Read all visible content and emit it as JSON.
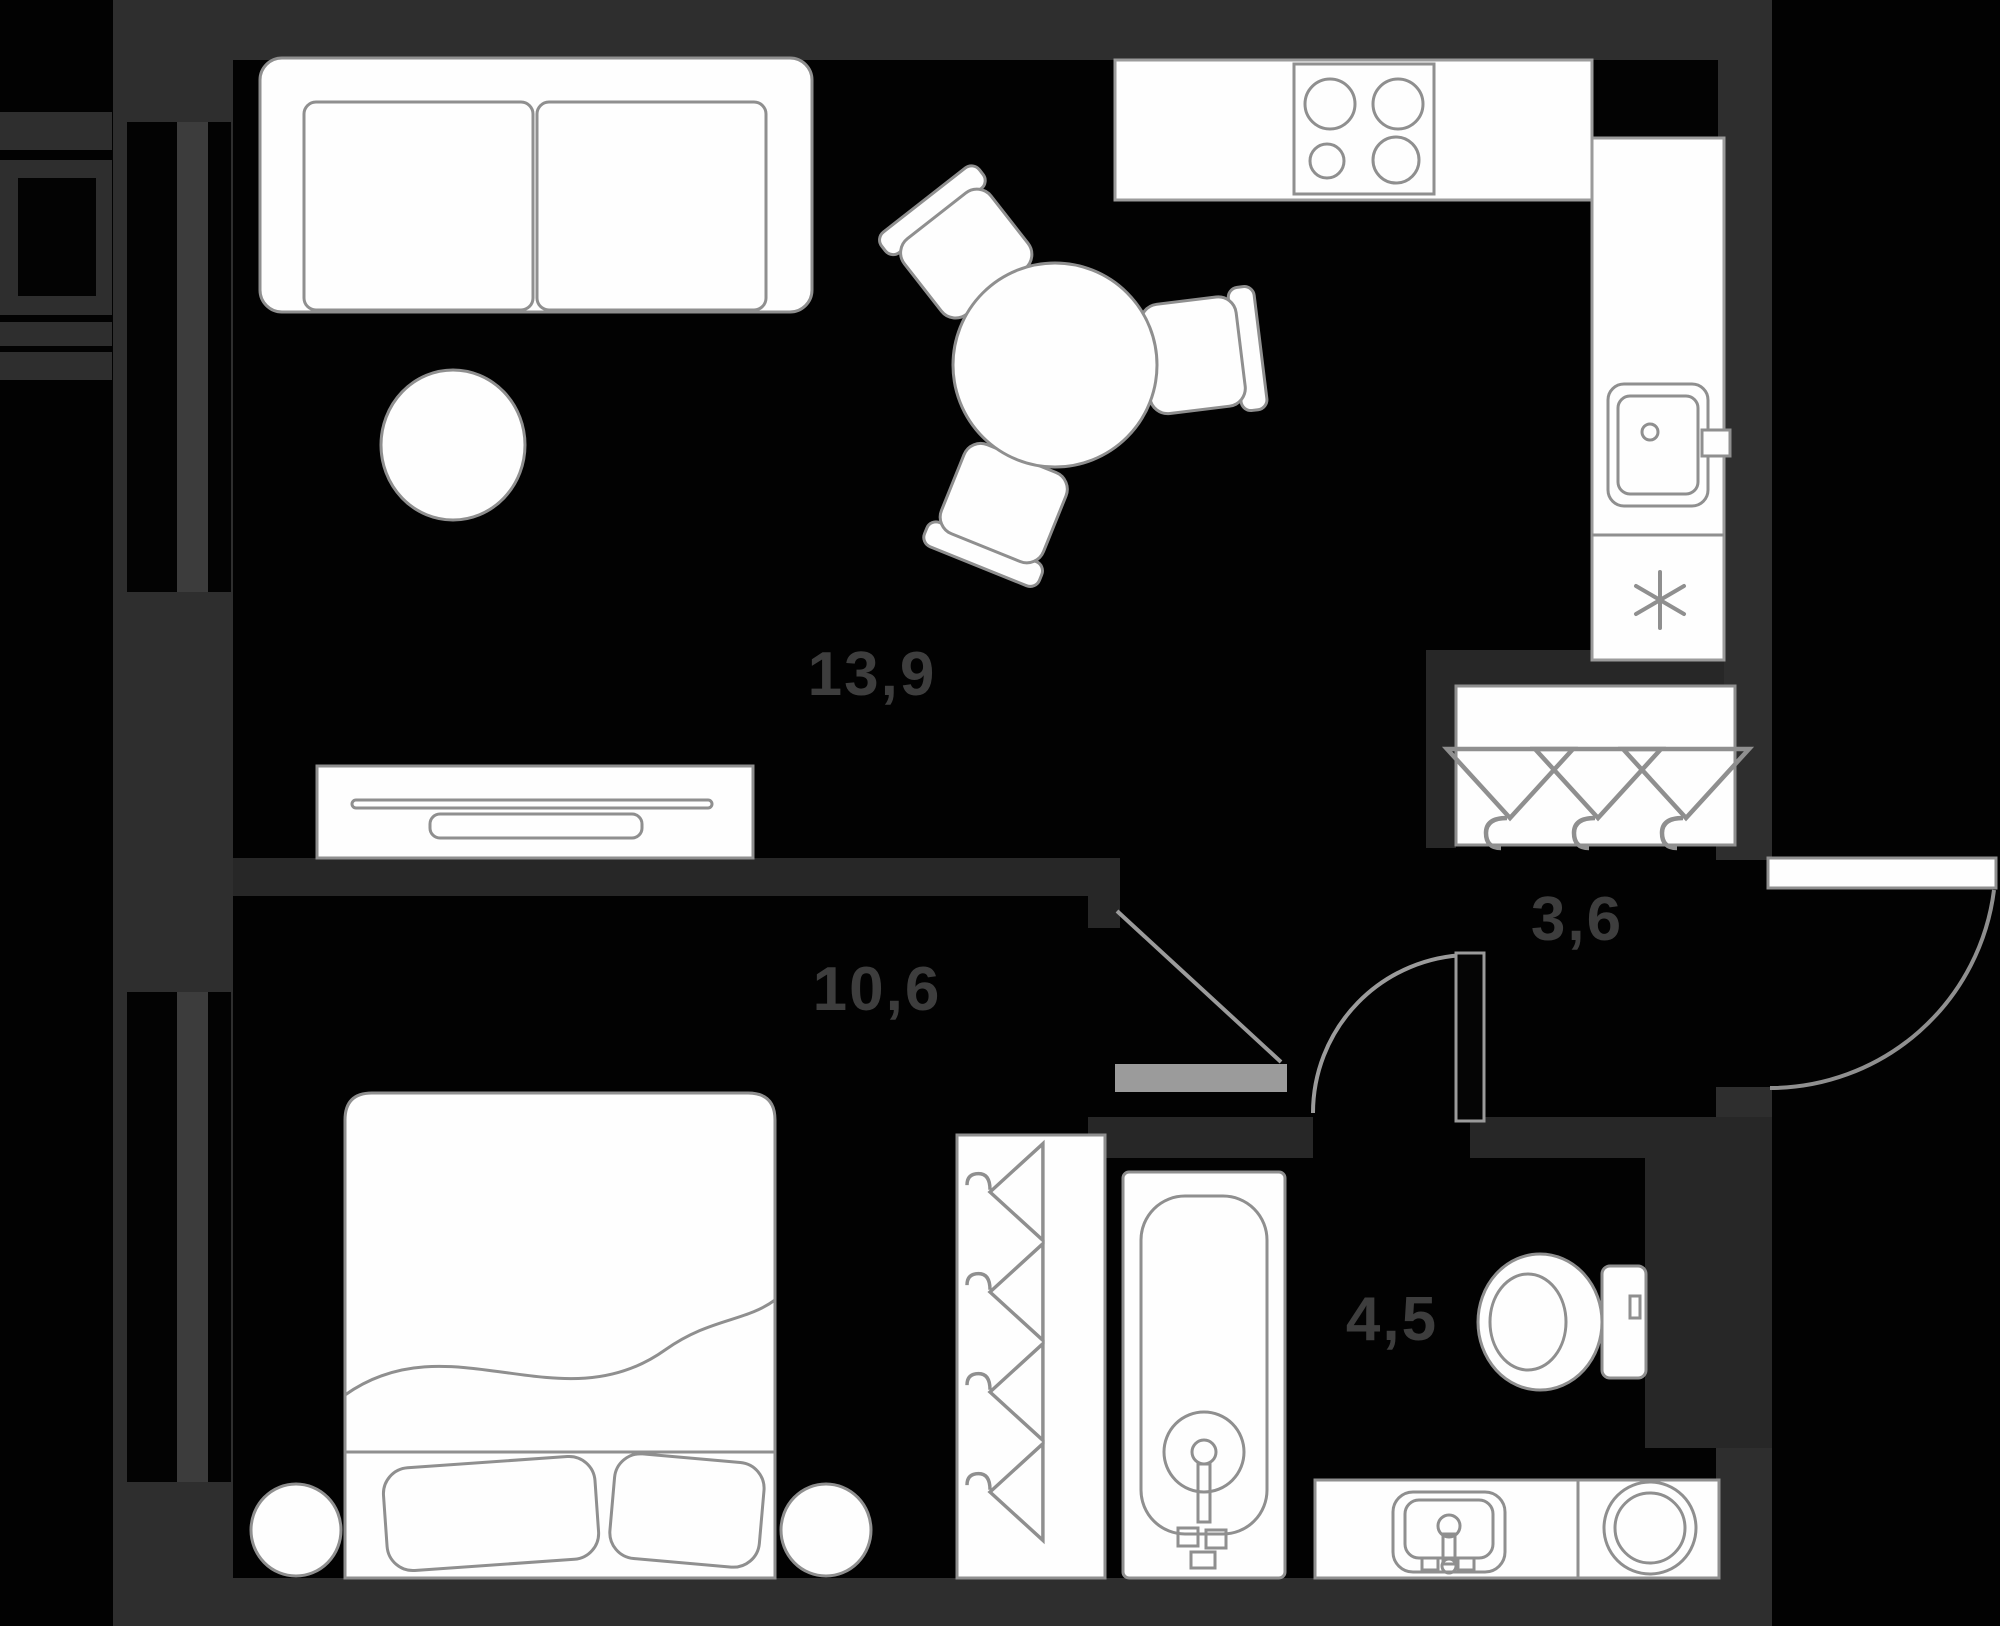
{
  "plan": {
    "type": "apartment-floor-plan",
    "rooms": [
      {
        "id": "living-kitchen",
        "area": "13,9"
      },
      {
        "id": "bedroom",
        "area": "10,6"
      },
      {
        "id": "hallway",
        "area": "3,6"
      },
      {
        "id": "bathroom",
        "area": "4,5"
      }
    ]
  },
  "icons": {
    "fridge": "snowflake-asterisk",
    "closet": "clothes-hangers",
    "wardrobe": "clothes-hangers"
  },
  "colors": {
    "background": "#020202",
    "wall_exterior": "#2e2e2e",
    "wall_interior": "#272727",
    "furniture_fill": "#fefefe",
    "furniture_outline": "#8f8f8f",
    "door_symbol": "#9b9b9b",
    "label_text": "#3d3d3d"
  }
}
